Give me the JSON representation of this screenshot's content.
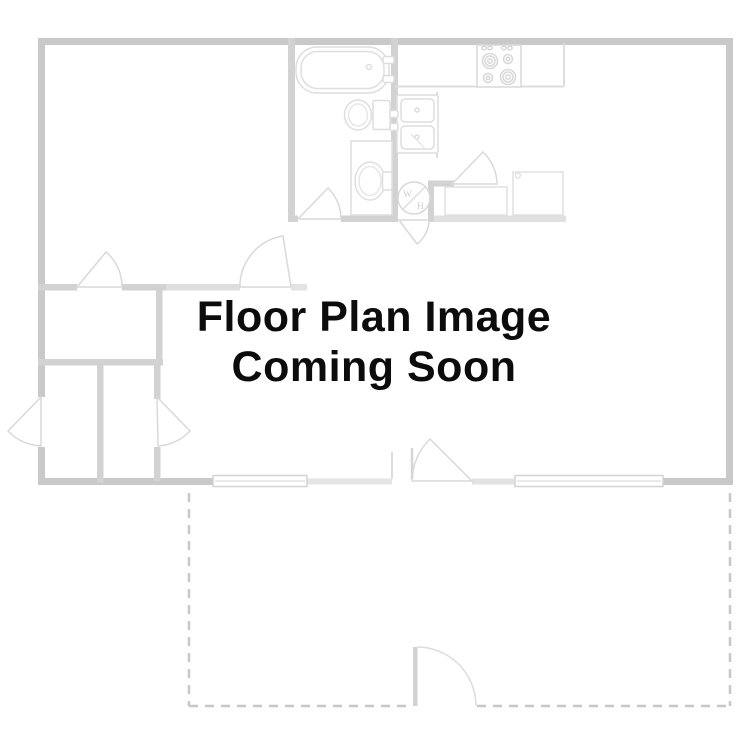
{
  "placeholder": {
    "title_line1": "Floor Plan Image",
    "title_line2": "Coming Soon",
    "text_color": "#0c0c0c"
  },
  "floorplan": {
    "water_heater_label_top": "W",
    "water_heater_label_bottom": "H",
    "colors": {
      "background": "#ffffff",
      "outer_wall": "#c9c9c9",
      "interior_wall": "#d2d2d2",
      "fixture_line": "#dedede",
      "patio_dash": "#c8c8c8"
    },
    "fixtures": [
      "bathtub",
      "toilet",
      "vanity-sink",
      "kitchen-sink",
      "stove",
      "refrigerator",
      "kitchen-counter",
      "water-heater",
      "window",
      "window",
      "door-swing",
      "patio-dashed-outline",
      "gate-door"
    ]
  }
}
